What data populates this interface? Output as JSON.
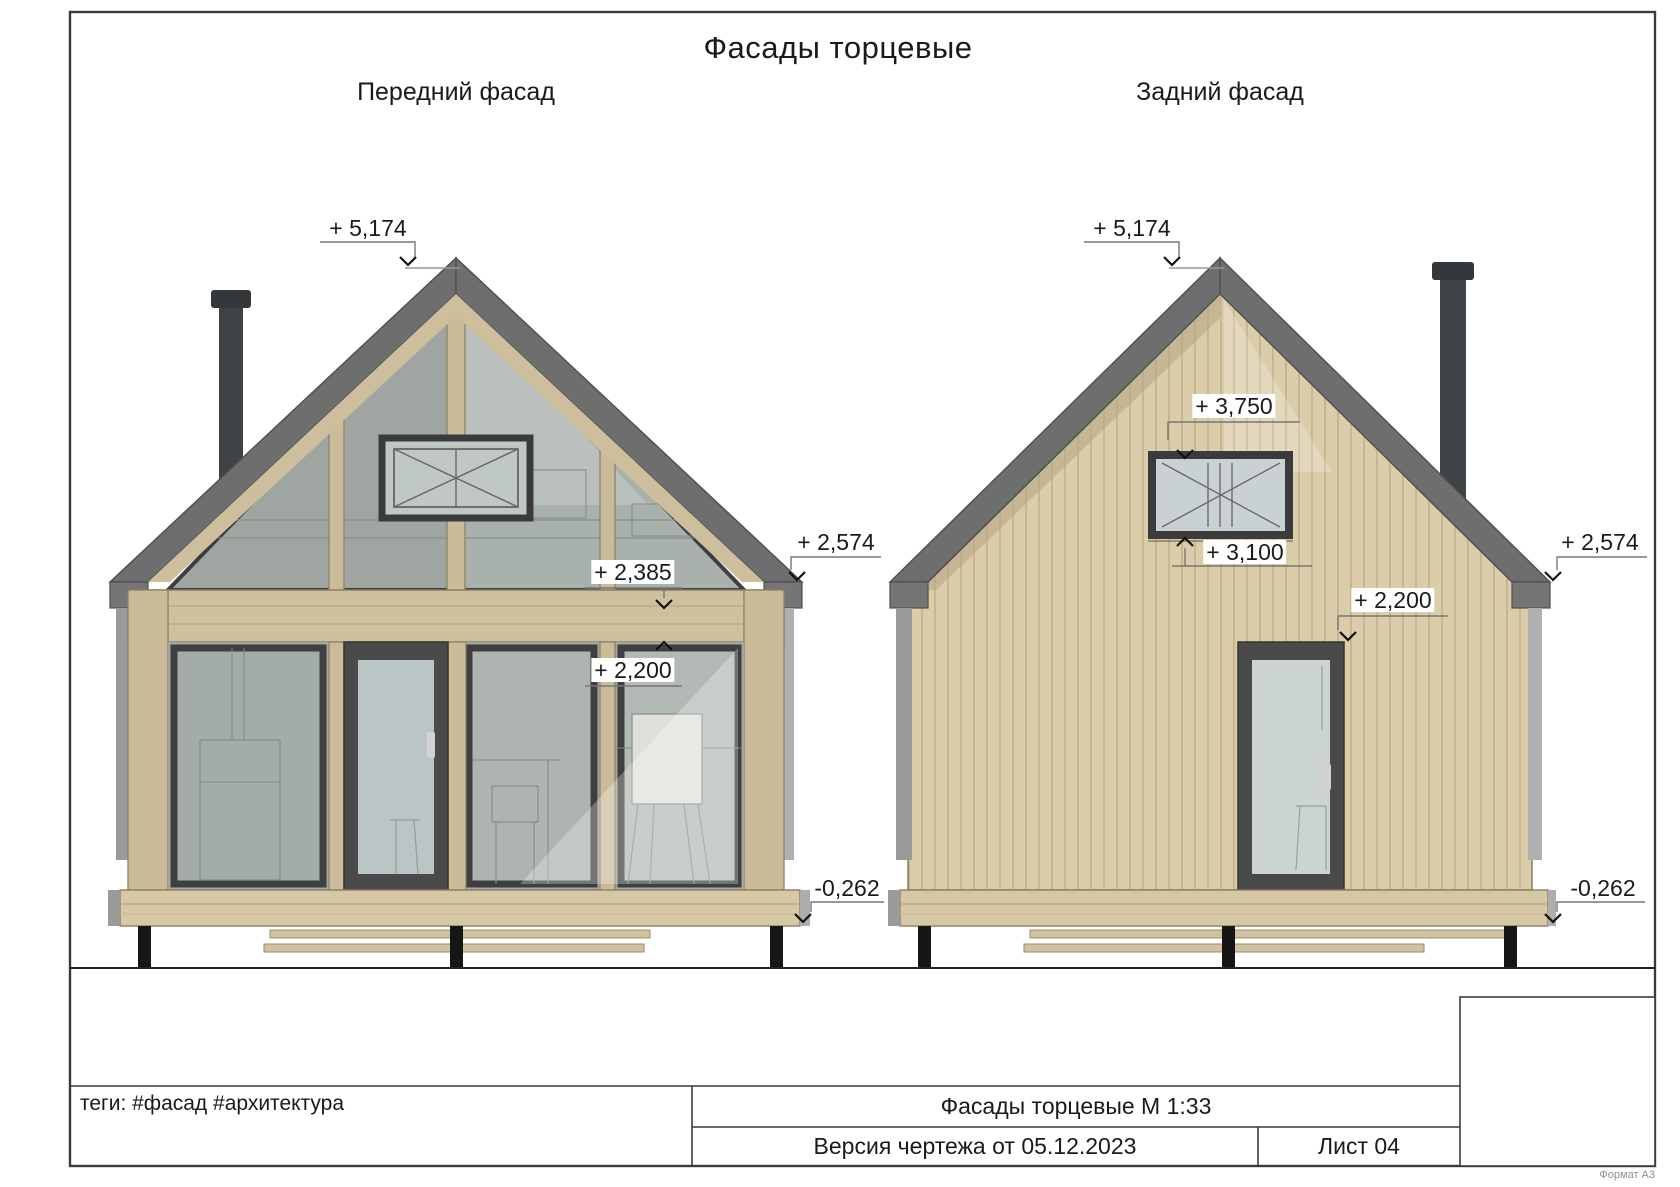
{
  "page": {
    "title": "Фасады торцевые",
    "format_label": "Формат А3"
  },
  "facades": {
    "front": {
      "label": "Передний фасад"
    },
    "rear": {
      "label": "Задний фасад"
    }
  },
  "elevation_marks": {
    "front_peak": "+ 5,174",
    "front_transom_top": "+ 2,385",
    "front_door_top": "+ 2,200",
    "front_eave": "+ 2,574",
    "front_base": "-0,262",
    "rear_peak": "+ 5,174",
    "rear_window_top": "+ 3,750",
    "rear_window_bottom": "+ 3,100",
    "rear_door_top": "+ 2,200",
    "rear_eave": "+ 2,574",
    "rear_base": "-0,262"
  },
  "title_block": {
    "tags": "теги: #фасад #архитектура",
    "drawing_title": "Фасады торцевые М 1:33",
    "version": "Версия чертежа от 05.12.2023",
    "sheet": "Лист 04"
  },
  "colors": {
    "roof": "#6e6e6e",
    "wood_frame": "#cbbc99",
    "siding": "#dbcda9",
    "glass": "#a9b1ad",
    "door_frame": "#4a4a4a",
    "deck": "#d6c8a4",
    "post": "#161616"
  }
}
